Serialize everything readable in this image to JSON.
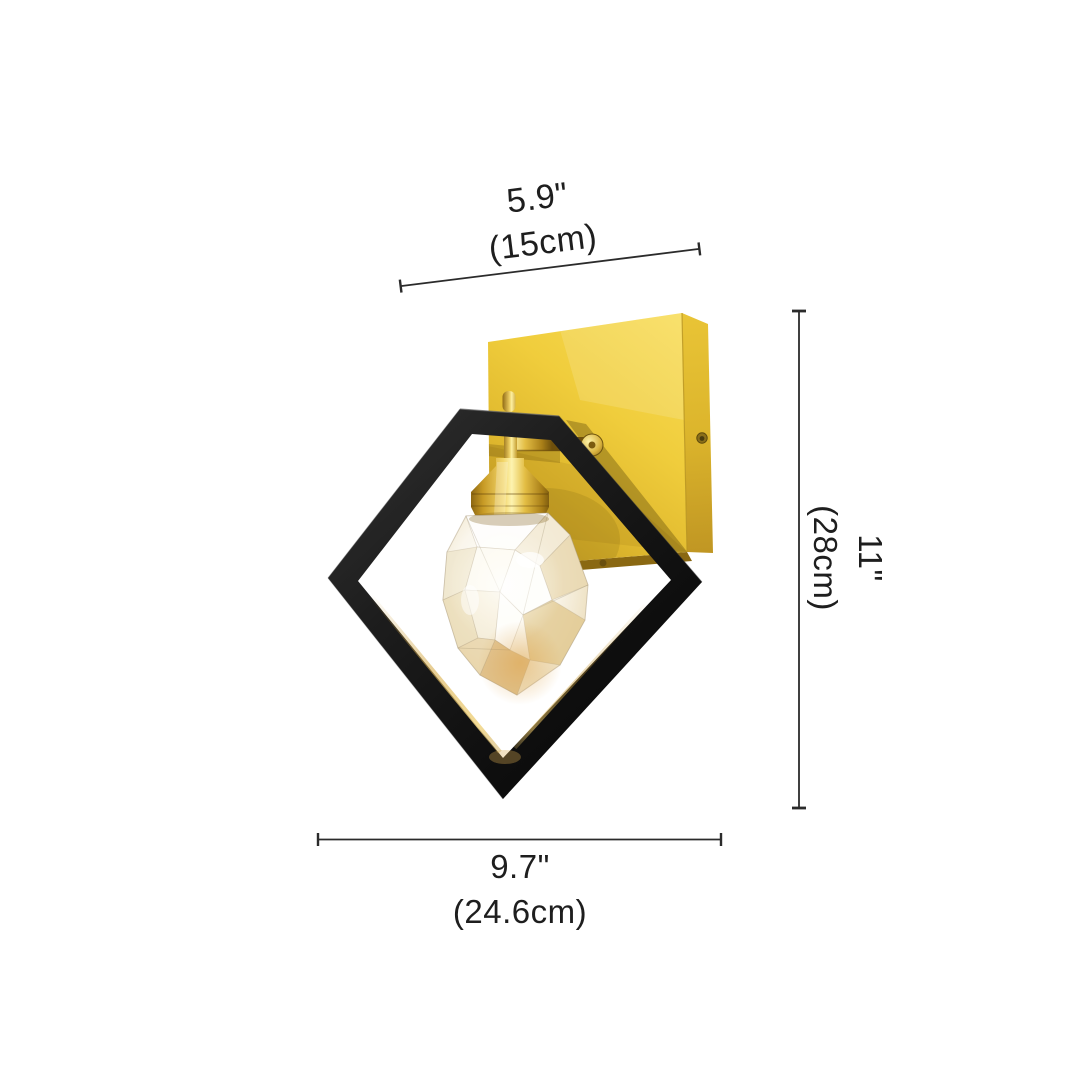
{
  "diagram": {
    "type": "product-dimension-diagram",
    "subject": "crystal-diamond-wall-sconce",
    "background": "#ffffff"
  },
  "dimensions": {
    "top_width": {
      "inches": "5.9\"",
      "metric": "(15cm)"
    },
    "side_height": {
      "inches": "11\"",
      "metric": "(28cm)"
    },
    "bottom_width": {
      "inches": "9.7\"",
      "metric": "(24.6cm)"
    }
  },
  "style": {
    "dimension_line_color": "#2b2b2b",
    "text_color": "#1e1e1e",
    "gold_plate": "#eec73e",
    "brass": "#d9b33f",
    "frame_black": "#1a1a1a",
    "crystal_tint": "#efe3c6"
  }
}
